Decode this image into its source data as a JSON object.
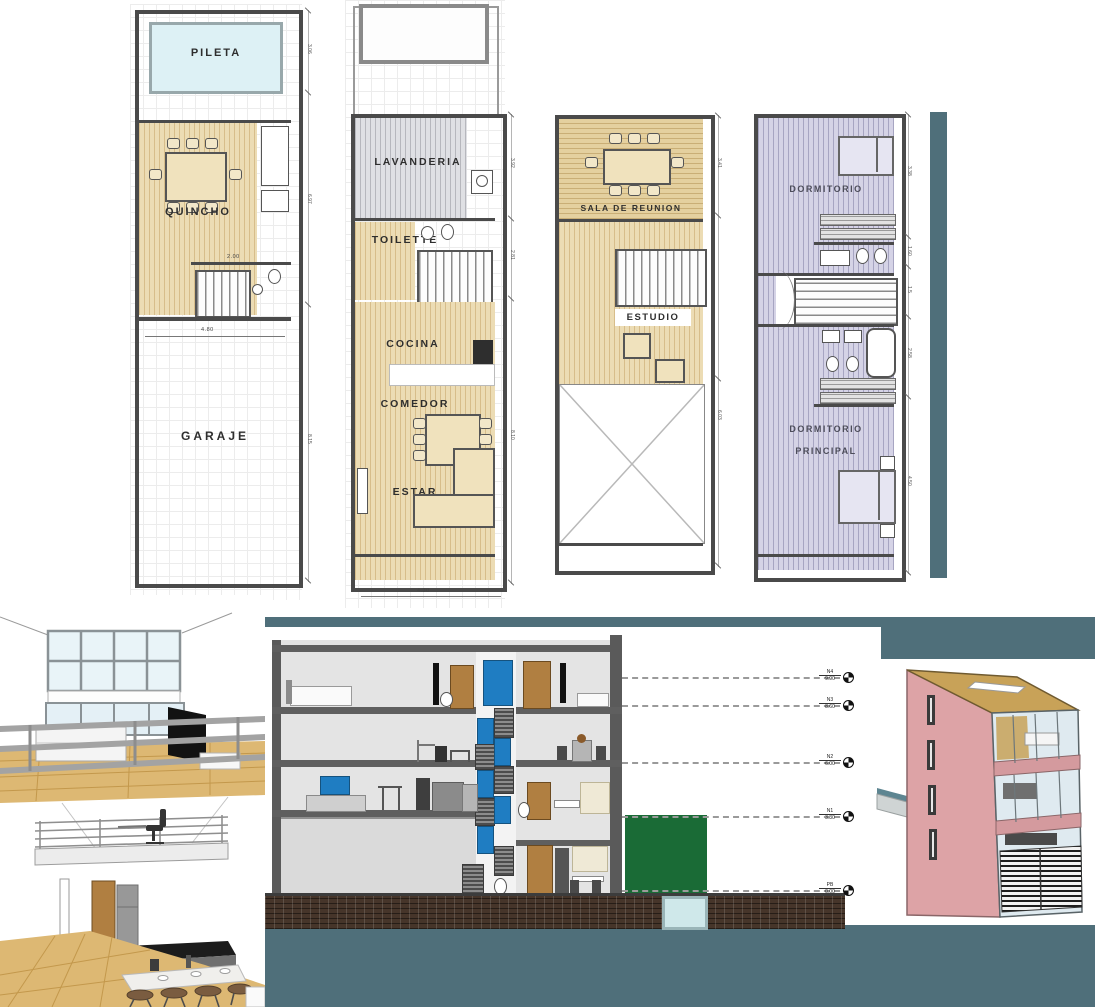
{
  "colors": {
    "teal_band": "#4f6f7a",
    "brick_ground": "#46352a",
    "building_pink": "#dda3a6",
    "roof_tan": "#c8a258",
    "plan_wood_tan": "#ecdcb4",
    "plan_lavender": "#d5d3e6",
    "plan_gray": "#dfe0e4",
    "pool_blue": "#ddf1f5",
    "wall_dark": "#4a4a4a",
    "section_window_blue": "#1f7dc2",
    "section_green_wall": "#1a6b36",
    "door_brown": "#b07f41",
    "render_wood": "#ddb873"
  },
  "plans": {
    "p1": {
      "pileta": "PILETA",
      "quincho": "QUINCHO",
      "garaje": "GARAJE",
      "dim_width": "4.80",
      "dim_bath": "2.00",
      "side_dims": [
        "3.06",
        "6.97",
        "8.15"
      ]
    },
    "p2": {
      "lavanderia": "LAVANDERIA",
      "toilette": "TOILETTE",
      "cocina": "COCINA",
      "comedor": "COMEDOR",
      "estar": "ESTAR",
      "dim_width": "4.30",
      "side_dims": [
        "3.92",
        "2.81",
        "8.10"
      ]
    },
    "p3": {
      "sala": "SALA DE REUNION",
      "estudio": "ESTUDIO",
      "side_dims": [
        "3.41",
        "6.03"
      ]
    },
    "p4": {
      "dormitorio": "DORMITORIO",
      "principal_line1": "DORMITORIO",
      "principal_line2": "PRINCIPAL",
      "side_dims": [
        "3.38",
        "1.60",
        "1.5",
        "2.58",
        "4.50"
      ]
    }
  },
  "section": {
    "levels": [
      {
        "name": "N4",
        "elev": "9.90"
      },
      {
        "name": "N3",
        "elev": "8.60"
      },
      {
        "name": "N2",
        "elev": "6.00"
      },
      {
        "name": "N1",
        "elev": "3.30"
      },
      {
        "name": "PB",
        "elev": "0.00"
      }
    ]
  }
}
